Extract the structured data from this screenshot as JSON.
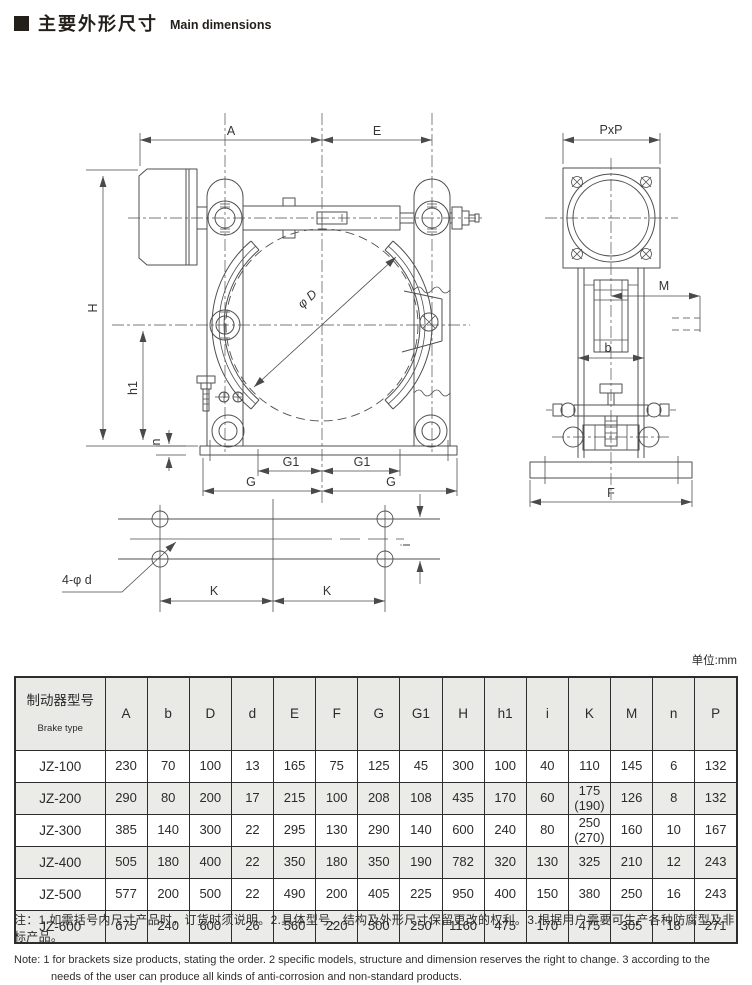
{
  "header": {
    "title_zh": "主要外形尺寸",
    "title_en": "Main dimensions"
  },
  "unit_label": "单位:mm",
  "drawing": {
    "labels": {
      "a": "A",
      "e": "E",
      "pxp": "PxP",
      "h": "H",
      "h1": "h1",
      "n": "n",
      "phi_d": "φ D",
      "g1": "G1",
      "g": "G",
      "m": "M",
      "b": "b",
      "f": "F",
      "i": "i",
      "k": "K",
      "holes": "4-φ d"
    }
  },
  "table": {
    "header": {
      "model_zh": "制动器型号",
      "model_en": "Brake type",
      "columns": [
        "A",
        "b",
        "D",
        "d",
        "E",
        "F",
        "G",
        "G1",
        "H",
        "h1",
        "i",
        "K",
        "M",
        "n",
        "P"
      ]
    },
    "rows": [
      {
        "model": "JZ-100",
        "values": [
          "230",
          "70",
          "100",
          "13",
          "165",
          "75",
          "125",
          "45",
          "300",
          "100",
          "40",
          "110",
          "145",
          "6",
          "132"
        ]
      },
      {
        "model": "JZ-200",
        "values": [
          "290",
          "80",
          "200",
          "17",
          "215",
          "100",
          "208",
          "108",
          "435",
          "170",
          "60",
          "175\n(190)",
          "126",
          "8",
          "132"
        ]
      },
      {
        "model": "JZ-300",
        "values": [
          "385",
          "140",
          "300",
          "22",
          "295",
          "130",
          "290",
          "140",
          "600",
          "240",
          "80",
          "250\n(270)",
          "160",
          "10",
          "167"
        ]
      },
      {
        "model": "JZ-400",
        "values": [
          "505",
          "180",
          "400",
          "22",
          "350",
          "180",
          "350",
          "190",
          "782",
          "320",
          "130",
          "325",
          "210",
          "12",
          "243"
        ]
      },
      {
        "model": "JZ-500",
        "values": [
          "577",
          "200",
          "500",
          "22",
          "490",
          "200",
          "405",
          "225",
          "950",
          "400",
          "150",
          "380",
          "250",
          "16",
          "243"
        ]
      },
      {
        "model": "JZ-600",
        "values": [
          "675",
          "240",
          "600",
          "26",
          "560",
          "220",
          "500",
          "250",
          "1160",
          "475",
          "170",
          "475",
          "305",
          "18",
          "271"
        ]
      }
    ]
  },
  "notes": {
    "zh": "注：1.如需括号内尺寸产品时，订货时须说明。2.具体型号、结构及外形尺寸保留更改的权利。3.根据用户需要可生产各种防腐型及非标产品。",
    "en": "Note: 1 for brackets size products, stating the order. 2 specific models, structure and dimension reserves the right to change. 3 according to the needs of the user can produce all kinds of anti-corrosion and non-standard products."
  }
}
